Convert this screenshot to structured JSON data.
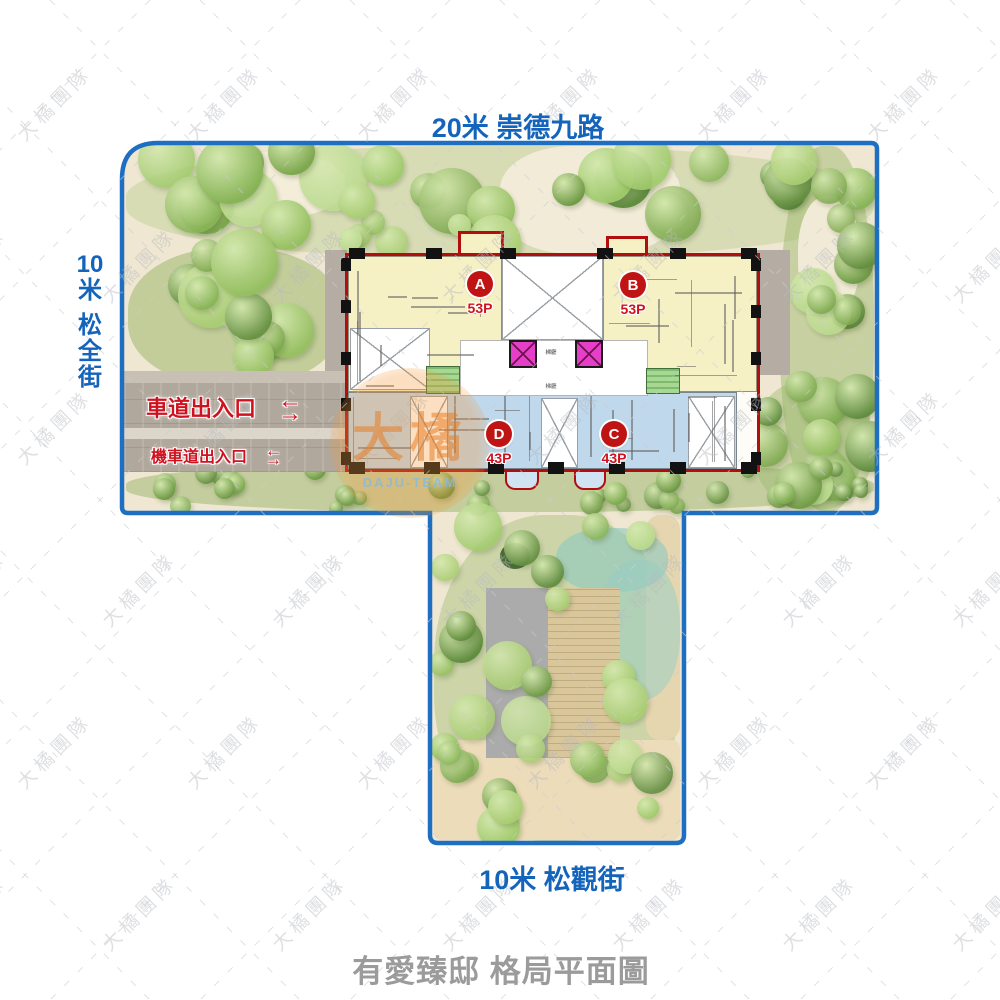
{
  "title": {
    "caption": "有愛臻邸 格局平面圖"
  },
  "roads": {
    "top": "20米 崇德九路",
    "left": "10米 松全街",
    "left_lines": [
      "10",
      "米",
      "松",
      "全",
      "街"
    ],
    "bottom": "10米 松觀街"
  },
  "entrances": {
    "car": "車道出入口",
    "moto": "機車道出入口"
  },
  "units": [
    {
      "id": "A",
      "area": "53P"
    },
    {
      "id": "B",
      "area": "53P"
    },
    {
      "id": "D",
      "area": "43P"
    },
    {
      "id": "C",
      "area": "43P"
    }
  ],
  "core": {
    "lobby": "梯廳"
  },
  "watermark": {
    "team": "大橘團隊",
    "badge_main": "大橘",
    "badge_sub": "DAJU-TEAM"
  },
  "icons": {
    "arrow_left": "←",
    "arrow_right": "→"
  },
  "colors": {
    "road_text": "#1464bb",
    "boundary": "#1e6fc2",
    "building_outline": "#b20e0e",
    "unit_ab": "#f6f0c5",
    "unit_cd": "#bfd8ec",
    "elevator": "#e43fc6",
    "stair": "#a6d893",
    "entrance_text": "#cf1220",
    "badge_bg": "#c01414",
    "caption_text": "#9b9b9b",
    "driveway": "#b1a89d"
  }
}
